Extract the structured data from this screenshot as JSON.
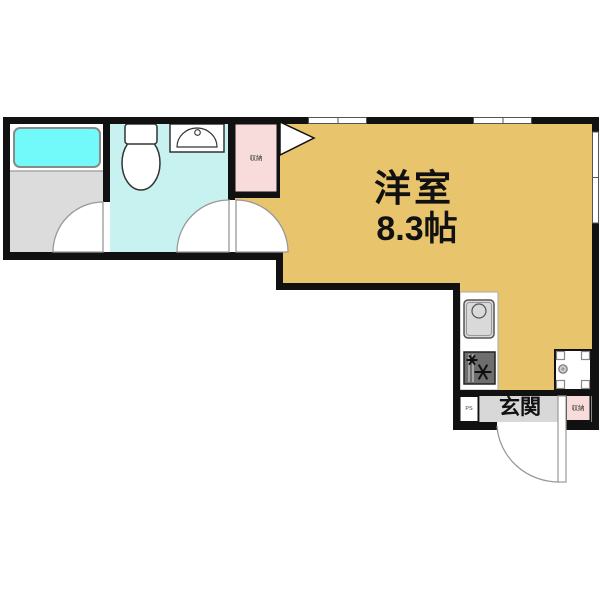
{
  "rooms": {
    "main_room": {
      "label": "洋室",
      "size": "8.3帖",
      "fill": "#E8C46C"
    },
    "entrance": {
      "label": "玄関",
      "fill": "#D8D8D8"
    },
    "entrance_closet": {
      "label": "収納",
      "fill": "#F8DCDC"
    },
    "hall_closet": {
      "label": "収納",
      "fill": "#F8DCDC"
    },
    "pipe_space": {
      "label": "PS"
    },
    "bathroom": {
      "floor_fill": "#DCDCDC",
      "bathtub_fill": "#72FAFA"
    },
    "toilet_room": {
      "fill": "#C8F2F0"
    }
  },
  "fixtures": {
    "bathtub": "bathtub-icon",
    "toilet": "toilet-icon",
    "washbasin": "washbasin-icon",
    "kitchen_sink": "kitchen-sink-icon",
    "gas_stove": "gas-stove-icon",
    "washing_machine": "washing-machine-space-icon"
  },
  "colors": {
    "wall": "#111111",
    "fixture_outline": "#333333",
    "door_arc": "#999999",
    "window_frame": "#555555"
  }
}
